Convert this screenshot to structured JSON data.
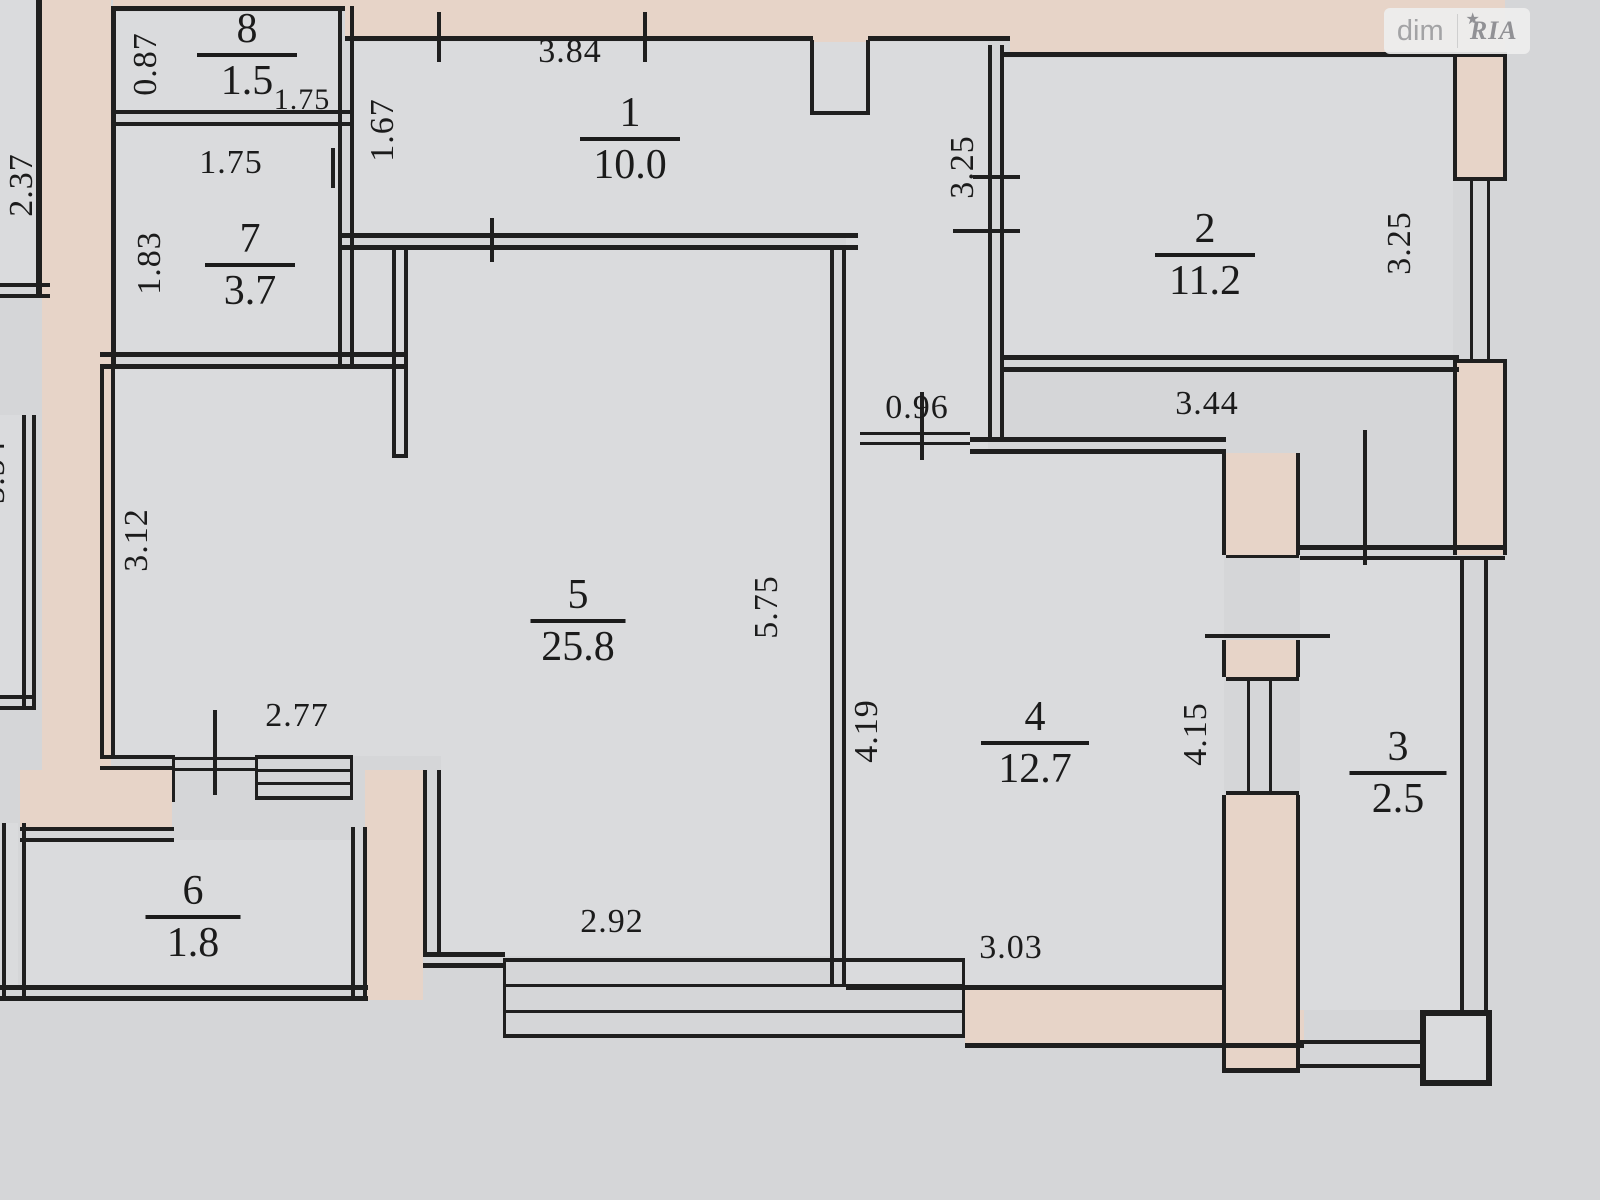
{
  "watermark": {
    "left": "dim",
    "right": "RIA",
    "star": "★"
  },
  "rooms": [
    {
      "number": "1",
      "area": "10.0"
    },
    {
      "number": "2",
      "area": "11.2"
    },
    {
      "number": "3",
      "area": "2.5"
    },
    {
      "number": "4",
      "area": "12.7"
    },
    {
      "number": "5",
      "area": "25.8"
    },
    {
      "number": "6",
      "area": "1.8"
    },
    {
      "number": "7",
      "area": "3.7"
    },
    {
      "number": "8",
      "area": "1.5"
    }
  ],
  "dims": [
    {
      "value": "0.87"
    },
    {
      "value": "1.75"
    },
    {
      "value": "1.75"
    },
    {
      "value": "1.83"
    },
    {
      "value": "2.37"
    },
    {
      "value": "3.54"
    },
    {
      "value": "1.67"
    },
    {
      "value": "3.84"
    },
    {
      "value": "3.25"
    },
    {
      "value": "3.25"
    },
    {
      "value": "3.44"
    },
    {
      "value": "0.96"
    },
    {
      "value": "3.12"
    },
    {
      "value": "5.75"
    },
    {
      "value": "2.77"
    },
    {
      "value": "2.92"
    },
    {
      "value": "4.19"
    },
    {
      "value": "4.15"
    },
    {
      "value": "3.03"
    }
  ]
}
